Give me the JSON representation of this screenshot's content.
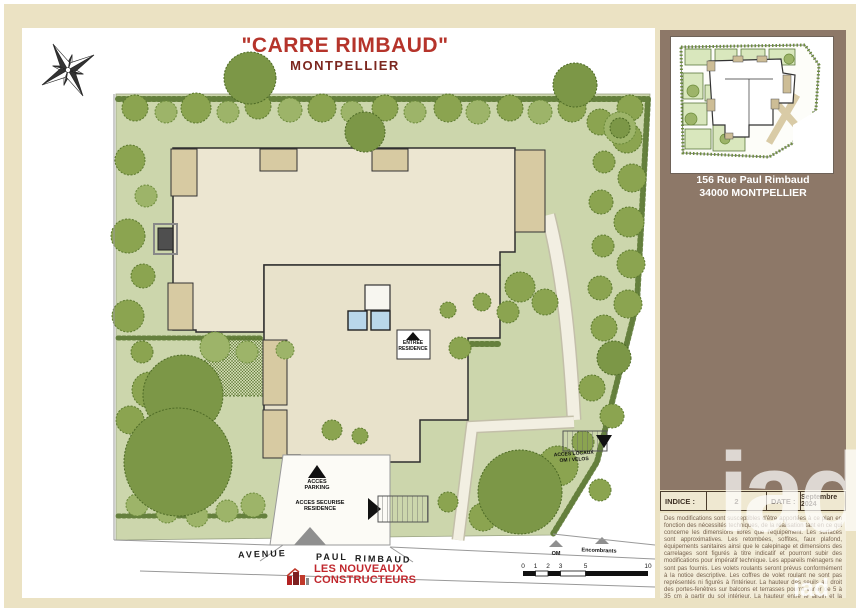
{
  "title": {
    "main": "\"CARRE RIMBAUD\"",
    "subtitle": "MONTPELLIER"
  },
  "plan": {
    "labels": {
      "entree": {
        "l1": "ENTREE",
        "l2": "RESIDENCE"
      },
      "parking": {
        "l1": "ACCES",
        "l2": "PARKING"
      },
      "securise": {
        "l1": "ACCES SECURISE",
        "l2": "RESIDENCE"
      },
      "locaux": {
        "l1": "ACCES LOCAUX",
        "l2": "OM / VELOS"
      },
      "om": "OM",
      "encombrants": "Encombrants"
    },
    "street": {
      "w1": "AVENUE",
      "w2": "PAUL",
      "w3": "RIMBAUD"
    },
    "scale": [
      "0",
      "1",
      "2",
      "3",
      "5",
      "10"
    ],
    "icons": {
      "compass": "compass-rose-icon",
      "entrance_arrows": "direction-triangle-icons"
    }
  },
  "footer": {
    "logo_l1": "LES NOUVEAUX",
    "logo_l2": "CONSTRUCTEURS"
  },
  "sidebar": {
    "address1": "156 Rue Paul Rimbaud",
    "address2": "34000 MONTPELLIER",
    "indice_label": "INDICE :",
    "indice_value": "2",
    "date_label": "DATE :",
    "date_value": "Septembre 2024",
    "disclaimer": "Des modifications sont susceptibles d'être apportées à ce plan en fonction des nécessités techniques, de la réalisation tant en ce qui concerne les dimensions libres que l'équipement. Les surfaces sont approximatives. Les retombées, soffites, faux plafond, équipements sanitaires ainsi que le calepinage et dimensions des carrelages sont figurés à titre indicatif et pourront subir des modifications pour impératif technique. Les appareils ménagers ne sont pas fournis. Les volets roulants seront prévus conformément à la notice descriptive. Les coffres de volet roulant ne sont pas représentés ni figurés à l'intérieur. La hauteur des seuils au droit des portes-fenêtres sur balcons et terrasses pourra varier de 5 à 35 cm à partir du sol intérieur. La hauteur entre le jardin et la terrasse pourra varier entre 0 et 60 cm. Les jardins ne seront pas nécessairement plats et pourront comporter des talus et des pentes."
  },
  "watermark": {
    "big": "iad",
    "small": "iad"
  },
  "colors": {
    "page_band": "#ebe2c3",
    "sidebar_brown": "#8d7868",
    "title_red": "#b5342b",
    "subtitle_red": "#7c271f",
    "garden_green": "#ccd6ac",
    "tree_green": "#8ba450",
    "building_cream": "#ece6d1",
    "terrace_tan": "#d7caa2",
    "logo_red": "#c0272d"
  }
}
